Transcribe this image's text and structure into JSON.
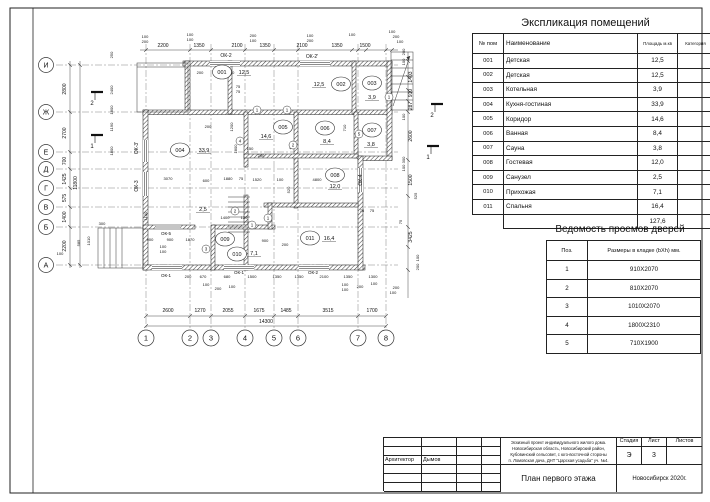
{
  "colors": {
    "line": "#1a1a1a",
    "paper": "#ffffff"
  },
  "explication": {
    "title": "Экспликация помещений",
    "headers": [
      "№ пом",
      "Наименование",
      "Площадь м.кв",
      "Категория"
    ],
    "rows": [
      {
        "num": "001",
        "name": "Детская",
        "area": "12,5"
      },
      {
        "num": "002",
        "name": "Детская",
        "area": "12,5"
      },
      {
        "num": "003",
        "name": "Котельная",
        "area": "3,9"
      },
      {
        "num": "004",
        "name": "Кухня-гостиная",
        "area": "33,9"
      },
      {
        "num": "005",
        "name": "Коридор",
        "area": "14,6"
      },
      {
        "num": "006",
        "name": "Ванная",
        "area": "8,4"
      },
      {
        "num": "007",
        "name": "Сауна",
        "area": "3,8"
      },
      {
        "num": "008",
        "name": "Гостевая",
        "area": "12,0"
      },
      {
        "num": "009",
        "name": "Санузел",
        "area": "2,5"
      },
      {
        "num": "010",
        "name": "Прихожая",
        "area": "7,1"
      },
      {
        "num": "011",
        "name": "Спальня",
        "area": "16,4"
      }
    ],
    "total": "127,6"
  },
  "doors": {
    "title": "Ведомость проемов дверей",
    "headers": [
      "Поз.",
      "Размеры в кладке (bXh) мм."
    ],
    "rows": [
      {
        "pos": "1",
        "size": "910X2070"
      },
      {
        "pos": "2",
        "size": "810X2070"
      },
      {
        "pos": "3",
        "size": "1010X2070"
      },
      {
        "pos": "4",
        "size": "1800X2310"
      },
      {
        "pos": "5",
        "size": "710X1900"
      }
    ]
  },
  "titleblock": {
    "architect_label": "Архитектор",
    "architect_name": "Дымов",
    "project_lines": [
      "Эскизный проект индивидуального жилого дома.",
      "Новосибирская область, Новосибирский район,",
      "Кубовинский сельсовет, с юго-восточной стороны",
      "п. Ломовская дача, ДНТ \"Царская усадьба\" уч. №4."
    ],
    "stage_label": "Стадия",
    "sheet_label": "Лист",
    "sheets_label": "Листов",
    "stage": "Э",
    "sheet": "3",
    "sheets": "",
    "drawing_title": "План первого этажа",
    "city_year": "Новосибирск 2020г."
  },
  "plan": {
    "axes_rows": [
      {
        "label": "И",
        "y": 65
      },
      {
        "label": "Ж",
        "y": 112
      },
      {
        "label": "Е",
        "y": 152
      },
      {
        "label": "Д",
        "y": 169
      },
      {
        "label": "Г",
        "y": 188
      },
      {
        "label": "В",
        "y": 207
      },
      {
        "label": "Б",
        "y": 227
      },
      {
        "label": "А",
        "y": 265
      }
    ],
    "axes_cols": [
      {
        "label": "1",
        "x": 146
      },
      {
        "label": "2",
        "x": 190
      },
      {
        "label": "3",
        "x": 211
      },
      {
        "label": "4",
        "x": 245
      },
      {
        "label": "5",
        "x": 274
      },
      {
        "label": "6",
        "x": 298
      },
      {
        "label": "7",
        "x": 358
      },
      {
        "label": "8",
        "x": 386
      }
    ],
    "rooms": [
      {
        "num": "001",
        "area": "12,5",
        "x": 222,
        "y": 72,
        "ax": 244,
        "ay": 74
      },
      {
        "num": "002",
        "area": "12,5",
        "x": 341,
        "y": 84,
        "ax": 319,
        "ay": 86
      },
      {
        "num": "003",
        "area": "3,9",
        "x": 372,
        "y": 83,
        "ax": 372,
        "ay": 99
      },
      {
        "num": "004",
        "area": "33,9",
        "x": 180,
        "y": 150,
        "ax": 204,
        "ay": 152
      },
      {
        "num": "005",
        "area": "14,6",
        "x": 283,
        "y": 127,
        "ax": 266,
        "ay": 138
      },
      {
        "num": "006",
        "area": "8,4",
        "x": 325,
        "y": 128,
        "ax": 327,
        "ay": 143
      },
      {
        "num": "007",
        "area": "3,8",
        "x": 372,
        "y": 130,
        "ax": 371,
        "ay": 146
      },
      {
        "num": "008",
        "area": "12,0",
        "x": 335,
        "y": 175,
        "ax": 335,
        "ay": 188
      },
      {
        "num": "009",
        "area": "2,5",
        "x": 225,
        "y": 239,
        "ax": 203,
        "ay": 211
      },
      {
        "num": "010",
        "area": "7,1",
        "x": 237,
        "y": 254,
        "ax": 254,
        "ay": 255
      },
      {
        "num": "011",
        "area": "16,4",
        "x": 310,
        "y": 238,
        "ax": 329,
        "ay": 240
      }
    ],
    "windows": [
      {
        "t": "ОК-2",
        "x": 226,
        "y": 57
      },
      {
        "t": "ОК-2'",
        "x": 312,
        "y": 58
      },
      {
        "t": "ОК-3'",
        "x": 138,
        "y": 148,
        "r": -90
      },
      {
        "t": "ОК-3",
        "x": 138,
        "y": 186,
        "r": -90
      },
      {
        "t": "ОК-4",
        "x": 362,
        "y": 180,
        "r": -90
      },
      {
        "t": "ОК-5",
        "x": 166,
        "y": 235,
        "s": 4.5
      },
      {
        "t": "ОК-1",
        "x": 166,
        "y": 277,
        "s": 4.5
      },
      {
        "t": "ОК-1",
        "x": 239,
        "y": 274,
        "s": 4.5
      },
      {
        "t": "ОК-2",
        "x": 313,
        "y": 274,
        "s": 4.5
      }
    ],
    "door_marks": [
      {
        "n": "1",
        "x": 257,
        "y": 110
      },
      {
        "n": "1",
        "x": 287,
        "y": 110
      },
      {
        "n": "1",
        "x": 389,
        "y": 97
      },
      {
        "n": "5",
        "x": 359,
        "y": 134
      },
      {
        "n": "2",
        "x": 293,
        "y": 145
      },
      {
        "n": "4",
        "x": 240,
        "y": 141
      },
      {
        "n": "2",
        "x": 235,
        "y": 211
      },
      {
        "n": "1",
        "x": 252,
        "y": 225
      },
      {
        "n": "1",
        "x": 268,
        "y": 218
      },
      {
        "n": "3",
        "x": 206,
        "y": 249
      }
    ],
    "sections": [
      {
        "n": "2",
        "x": 97,
        "y": 92
      },
      {
        "n": "1",
        "x": 97,
        "y": 135
      },
      {
        "n": "2",
        "x": 437,
        "y": 104
      },
      {
        "n": "1",
        "x": 433,
        "y": 146
      }
    ],
    "dims": [
      {
        "t": "2200",
        "x": 163,
        "y": 47
      },
      {
        "t": "1350",
        "x": 199,
        "y": 47
      },
      {
        "t": "2100",
        "x": 237,
        "y": 47
      },
      {
        "t": "1350",
        "x": 265,
        "y": 47
      },
      {
        "t": "2100",
        "x": 302,
        "y": 47
      },
      {
        "t": "1350",
        "x": 337,
        "y": 47
      },
      {
        "t": "1500",
        "x": 365,
        "y": 47
      },
      {
        "t": "100",
        "x": 145,
        "y": 38,
        "s": 4
      },
      {
        "t": "200",
        "x": 145,
        "y": 43,
        "s": 4
      },
      {
        "t": "100",
        "x": 190,
        "y": 36,
        "s": 4
      },
      {
        "t": "100",
        "x": 190,
        "y": 41,
        "s": 4
      },
      {
        "t": "200",
        "x": 253,
        "y": 37,
        "s": 4
      },
      {
        "t": "100",
        "x": 253,
        "y": 42,
        "s": 4
      },
      {
        "t": "100",
        "x": 310,
        "y": 37,
        "s": 4
      },
      {
        "t": "200",
        "x": 310,
        "y": 42,
        "s": 4
      },
      {
        "t": "100",
        "x": 352,
        "y": 36,
        "s": 4
      },
      {
        "t": "100",
        "x": 392,
        "y": 33,
        "s": 4
      },
      {
        "t": "200",
        "x": 396,
        "y": 38,
        "s": 4
      },
      {
        "t": "100",
        "x": 400,
        "y": 43,
        "s": 4
      },
      {
        "t": "2800",
        "x": 66,
        "y": 89,
        "r": -90
      },
      {
        "t": "2700",
        "x": 66,
        "y": 133,
        "r": -90
      },
      {
        "t": "700",
        "x": 66,
        "y": 161,
        "r": -90
      },
      {
        "t": "1425",
        "x": 66,
        "y": 179,
        "r": -90
      },
      {
        "t": "575",
        "x": 66,
        "y": 198,
        "r": -90
      },
      {
        "t": "1400",
        "x": 66,
        "y": 217,
        "r": -90
      },
      {
        "t": "2200",
        "x": 66,
        "y": 246,
        "r": -90
      },
      {
        "t": "11800",
        "x": 77,
        "y": 183,
        "r": -90
      },
      {
        "t": "250",
        "x": 113,
        "y": 55,
        "r": -90,
        "s": 4
      },
      {
        "t": "2400",
        "x": 113,
        "y": 90,
        "r": -90,
        "s": 4
      },
      {
        "t": "1800",
        "x": 113,
        "y": 110,
        "r": -90,
        "s": 4
      },
      {
        "t": "1190",
        "x": 113,
        "y": 127,
        "r": -90,
        "s": 4
      },
      {
        "t": "1800",
        "x": 113,
        "y": 151,
        "r": -90,
        "s": 4
      },
      {
        "t": "1100",
        "x": 147,
        "y": 216,
        "r": -90,
        "s": 4
      },
      {
        "t": "300",
        "x": 102,
        "y": 225,
        "s": 4
      },
      {
        "t": "1010",
        "x": 90,
        "y": 241,
        "r": -90,
        "s": 4
      },
      {
        "t": "585",
        "x": 80,
        "y": 243,
        "r": -90,
        "s": 4
      },
      {
        "t": "100",
        "x": 60,
        "y": 255,
        "s": 4
      },
      {
        "t": "200",
        "x": 188,
        "y": 278,
        "s": 4
      },
      {
        "t": "670",
        "x": 203,
        "y": 278,
        "s": 4
      },
      {
        "t": "680",
        "x": 227,
        "y": 278,
        "s": 4
      },
      {
        "t": "1500",
        "x": 252,
        "y": 278,
        "s": 4
      },
      {
        "t": "1350",
        "x": 277,
        "y": 278,
        "s": 4
      },
      {
        "t": "1350",
        "x": 299,
        "y": 278,
        "s": 4
      },
      {
        "t": "2100",
        "x": 324,
        "y": 278,
        "s": 4
      },
      {
        "t": "1350",
        "x": 348,
        "y": 278,
        "s": 4
      },
      {
        "t": "1300",
        "x": 373,
        "y": 278,
        "s": 4
      },
      {
        "t": "100",
        "x": 206,
        "y": 286,
        "s": 4
      },
      {
        "t": "200",
        "x": 218,
        "y": 290,
        "s": 4
      },
      {
        "t": "100",
        "x": 232,
        "y": 288,
        "s": 4
      },
      {
        "t": "100",
        "x": 345,
        "y": 286,
        "s": 4
      },
      {
        "t": "100",
        "x": 345,
        "y": 291,
        "s": 4
      },
      {
        "t": "200",
        "x": 360,
        "y": 288,
        "s": 4
      },
      {
        "t": "100",
        "x": 374,
        "y": 285,
        "s": 4
      },
      {
        "t": "200",
        "x": 396,
        "y": 289,
        "s": 4
      },
      {
        "t": "100",
        "x": 393,
        "y": 294,
        "s": 4
      },
      {
        "t": "2600",
        "x": 168,
        "y": 312
      },
      {
        "t": "1270",
        "x": 200,
        "y": 312
      },
      {
        "t": "2055",
        "x": 228,
        "y": 312
      },
      {
        "t": "1675",
        "x": 259,
        "y": 312
      },
      {
        "t": "1485",
        "x": 286,
        "y": 312
      },
      {
        "t": "3515",
        "x": 328,
        "y": 312
      },
      {
        "t": "1700",
        "x": 372,
        "y": 312
      },
      {
        "t": "14300",
        "x": 266,
        "y": 323
      },
      {
        "t": "200",
        "x": 405,
        "y": 52,
        "r": -90,
        "s": 4
      },
      {
        "t": "100",
        "x": 405,
        "y": 62,
        "r": -90,
        "s": 4
      },
      {
        "t": "1403",
        "x": 412,
        "y": 77,
        "r": -90
      },
      {
        "t": "910",
        "x": 412,
        "y": 93,
        "r": -90
      },
      {
        "t": "287",
        "x": 412,
        "y": 106,
        "r": -90
      },
      {
        "t": "100",
        "x": 405,
        "y": 117,
        "r": -90,
        "s": 4
      },
      {
        "t": "2600",
        "x": 412,
        "y": 136,
        "r": -90
      },
      {
        "t": "300",
        "x": 405,
        "y": 160,
        "r": -90,
        "s": 4
      },
      {
        "t": "100",
        "x": 405,
        "y": 168,
        "r": -90,
        "s": 4
      },
      {
        "t": "1500",
        "x": 412,
        "y": 180,
        "r": -90
      },
      {
        "t": "525",
        "x": 417,
        "y": 196,
        "r": -90,
        "s": 4
      },
      {
        "t": "3425",
        "x": 412,
        "y": 237,
        "r": -90
      },
      {
        "t": "100",
        "x": 419,
        "y": 258,
        "r": -90,
        "s": 4
      },
      {
        "t": "200",
        "x": 419,
        "y": 267,
        "r": -90,
        "s": 4
      },
      {
        "t": "75",
        "x": 402,
        "y": 222,
        "r": -90,
        "s": 4
      },
      {
        "t": "3070",
        "x": 168,
        "y": 180,
        "s": 4
      },
      {
        "t": "600",
        "x": 206,
        "y": 182,
        "s": 4
      },
      {
        "t": "1880",
        "x": 228,
        "y": 180,
        "s": 4
      },
      {
        "t": "75",
        "x": 241,
        "y": 180,
        "s": 4
      },
      {
        "t": "1520",
        "x": 257,
        "y": 181,
        "s": 4
      },
      {
        "t": "100",
        "x": 280,
        "y": 181,
        "s": 4
      },
      {
        "t": "4800",
        "x": 317,
        "y": 181,
        "s": 4
      },
      {
        "t": "1400",
        "x": 225,
        "y": 219,
        "s": 4
      },
      {
        "t": "120",
        "x": 244,
        "y": 219,
        "s": 4
      },
      {
        "t": "900",
        "x": 265,
        "y": 242,
        "s": 4
      },
      {
        "t": "200",
        "x": 285,
        "y": 246,
        "s": 4
      },
      {
        "t": "900",
        "x": 150,
        "y": 241,
        "s": 4
      },
      {
        "t": "900",
        "x": 170,
        "y": 241,
        "s": 4
      },
      {
        "t": "1870",
        "x": 190,
        "y": 241,
        "s": 4
      },
      {
        "t": "100",
        "x": 163,
        "y": 248,
        "s": 4
      },
      {
        "t": "100",
        "x": 163,
        "y": 253,
        "s": 4
      },
      {
        "t": "200",
        "x": 208,
        "y": 128,
        "s": 4
      },
      {
        "t": "1200",
        "x": 233,
        "y": 127,
        "r": -90,
        "s": 4
      },
      {
        "t": "1800",
        "x": 237,
        "y": 149,
        "r": -90,
        "s": 4
      },
      {
        "t": "150",
        "x": 250,
        "y": 150,
        "s": 4
      },
      {
        "t": "200",
        "x": 261,
        "y": 157,
        "s": 4
      },
      {
        "t": "600",
        "x": 292,
        "y": 146,
        "r": -90,
        "s": 4
      },
      {
        "t": "710",
        "x": 346,
        "y": 128,
        "r": -90,
        "s": 4
      },
      {
        "t": "520",
        "x": 290,
        "y": 190,
        "r": -90,
        "s": 4
      },
      {
        "t": "200",
        "x": 200,
        "y": 74,
        "s": 4
      },
      {
        "t": "910",
        "x": 216,
        "y": 74,
        "s": 4
      },
      {
        "t": "150",
        "x": 231,
        "y": 74,
        "s": 4
      },
      {
        "t": "75",
        "x": 238,
        "y": 88,
        "s": 4
      },
      {
        "t": "75",
        "x": 238,
        "y": 93,
        "s": 4
      },
      {
        "t": "75",
        "x": 362,
        "y": 212,
        "s": 4
      },
      {
        "t": "75",
        "x": 372,
        "y": 212,
        "s": 4
      }
    ]
  }
}
